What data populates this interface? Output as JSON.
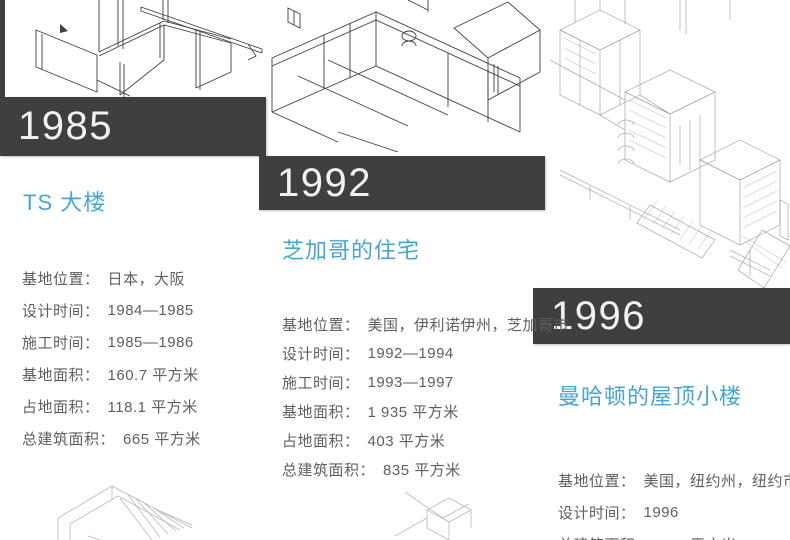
{
  "punct": {
    "colon": "："
  },
  "colors": {
    "banner_bg": "#3f3f3f",
    "banner_text": "#f2f2f2",
    "accent_blue": "#45a5d8",
    "detail_text": "#5f5f5f",
    "page_bg": "#ffffff"
  },
  "projects": [
    {
      "year": "1985",
      "title": "TS 大楼",
      "details": [
        {
          "label": "基地位置",
          "value": "日本，大阪"
        },
        {
          "label": "设计时间",
          "value": "1984—1985"
        },
        {
          "label": "施工时间",
          "value": "1985—1986"
        },
        {
          "label": "基地面积",
          "value": "160.7 平方米"
        },
        {
          "label": "占地面积",
          "value": "118.1 平方米"
        },
        {
          "label": "总建筑面积",
          "value": "665 平方米"
        }
      ]
    },
    {
      "year": "1992",
      "title": "芝加哥的住宅",
      "details": [
        {
          "label": "基地位置",
          "value": "美国，伊利诺伊州，芝加哥市"
        },
        {
          "label": "设计时间",
          "value": "1992—1994"
        },
        {
          "label": "施工时间",
          "value": "1993—1997"
        },
        {
          "label": "基地面积",
          "value": "1 935 平方米"
        },
        {
          "label": "占地面积",
          "value": "403 平方米"
        },
        {
          "label": "总建筑面积",
          "value": "835 平方米"
        }
      ]
    },
    {
      "year": "1996",
      "title": "曼哈顿的屋顶小楼",
      "details": [
        {
          "label": "基地位置",
          "value": "美国，纽约州，纽约市"
        },
        {
          "label": "设计时间",
          "value": "1996"
        },
        {
          "label": "总建筑面积",
          "value": "315 平方米"
        }
      ]
    }
  ]
}
